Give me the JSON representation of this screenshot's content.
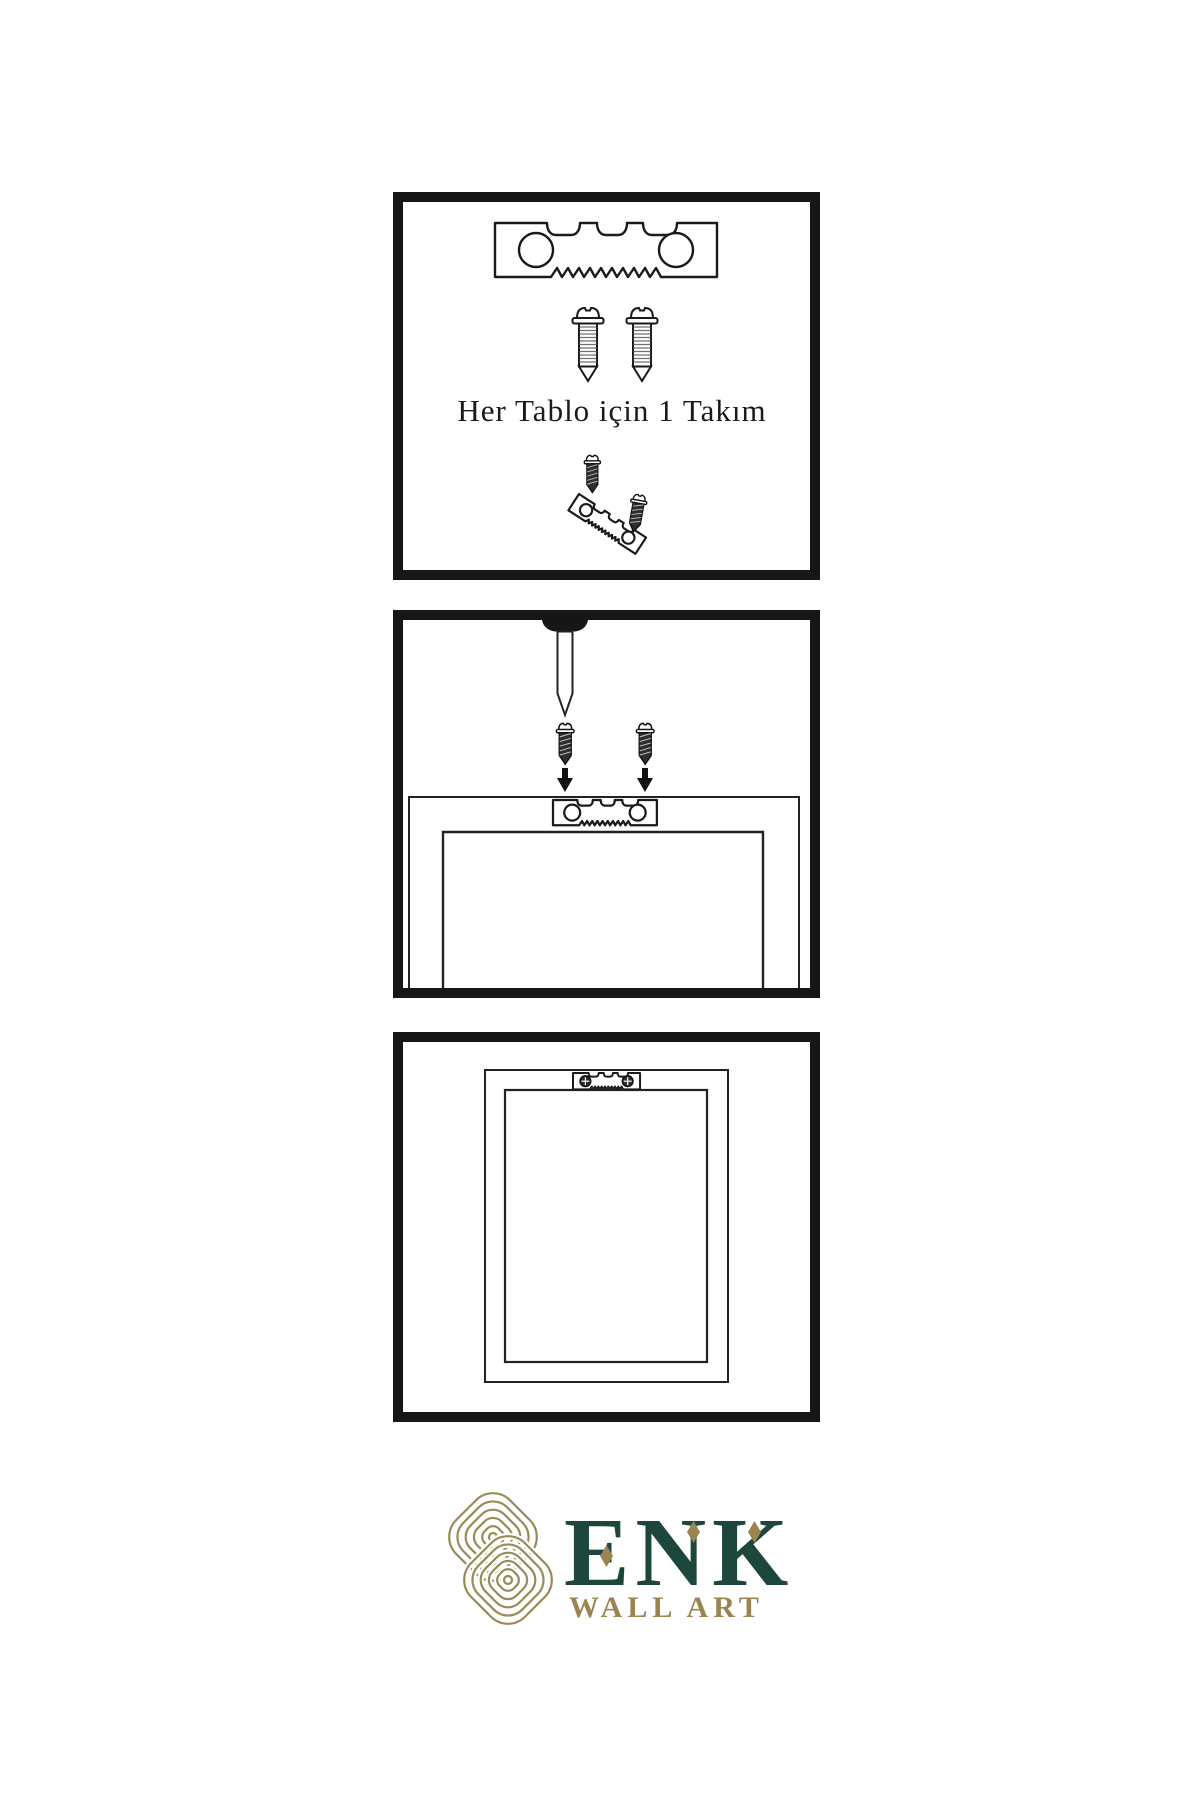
{
  "step1": {
    "caption": "Her Tablo için 1 Takım"
  },
  "brand": {
    "name": "ENK",
    "subtitle": "WALL ART"
  },
  "colors": {
    "ink": "#1a1a1a",
    "panel_border": "#161616",
    "metal_dark": "#2e2e2e",
    "brand_green": "#1d473c",
    "brand_gold": "#9a8450"
  },
  "icons": {
    "sawtooth_hanger": "sawtooth-hanger-icon",
    "screw_light": "screw-icon",
    "screw_dark": "dark-screw-icon",
    "nail": "wall-nail-icon",
    "arrow_down": "arrow-down-icon",
    "phillips_screw_head": "phillips-screw-head-icon",
    "knot": "knot-logo-icon"
  }
}
